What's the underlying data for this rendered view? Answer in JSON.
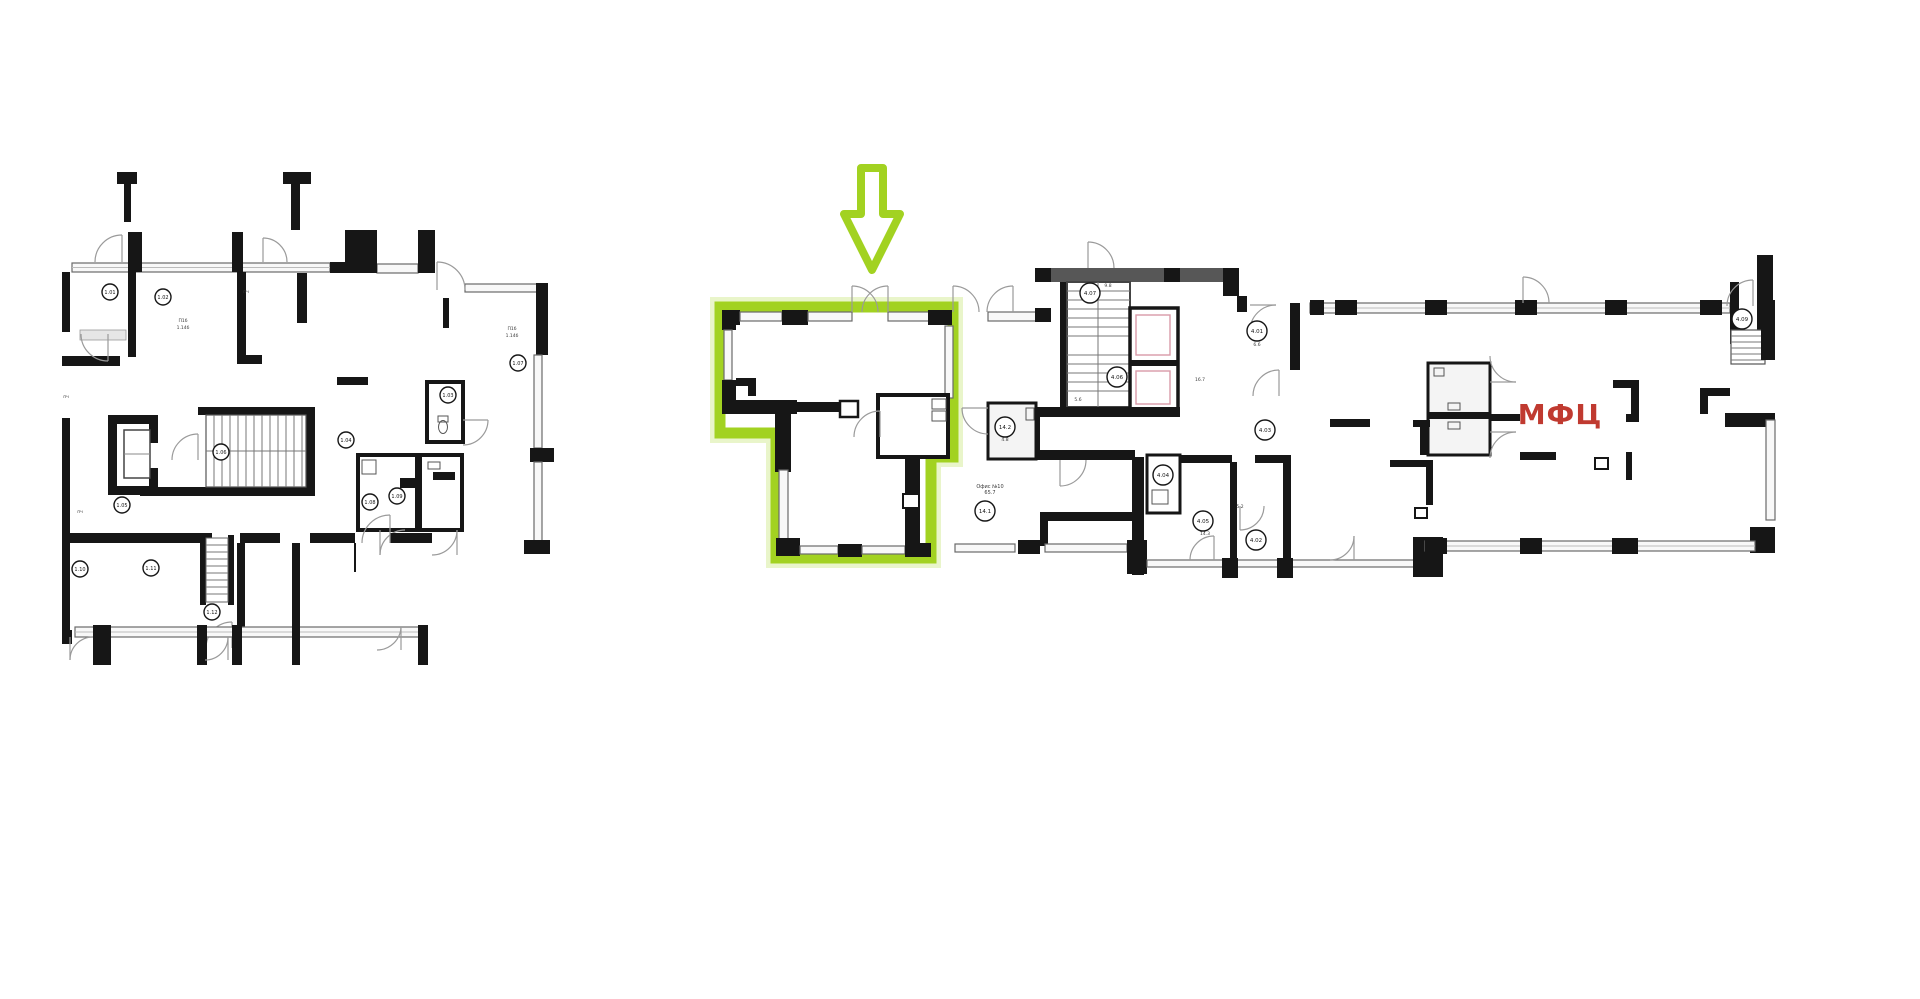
{
  "page": {
    "title": "floor-plan-view",
    "background": "#ffffff"
  },
  "colors": {
    "wall_black": "#161616",
    "wall_gray": "#575757",
    "window_edge": "#6a6a6a",
    "window_fill": "#f8f8f8",
    "door_arc": "#9a9a9a",
    "room_fill": "#f4f4f4",
    "elevator_pink": "#d99aa8",
    "highlight_green": "#a2d221",
    "highlight_glow": "#cfe98a",
    "label_red": "#c03a30",
    "note_gray": "#3a3a3a"
  },
  "annotations": {
    "mfc_label": "МФЦ",
    "arrow": "green-down-arrow pointing at highlighted unit"
  },
  "right_plan": {
    "office_note_line1": "Офис №10",
    "office_note_line2": "65.7",
    "room_markers": [
      {
        "label": "4.07",
        "x": 1090,
        "y": 293
      },
      {
        "label": "4.06",
        "x": 1117,
        "y": 377
      },
      {
        "label": "4.01",
        "x": 1257,
        "y": 331
      },
      {
        "label": "4.03",
        "x": 1265,
        "y": 430
      },
      {
        "label": "14.2",
        "x": 1005,
        "y": 427
      },
      {
        "label": "4.04",
        "x": 1163,
        "y": 475
      },
      {
        "label": "4.05",
        "x": 1203,
        "y": 521
      },
      {
        "label": "4.02",
        "x": 1256,
        "y": 540
      },
      {
        "label": "14.1",
        "x": 985,
        "y": 511
      },
      {
        "label": "4.09",
        "x": 1742,
        "y": 319
      }
    ],
    "notes": [
      {
        "text": "9.8",
        "x": 1108,
        "y": 287
      },
      {
        "text": "5.6",
        "x": 1078,
        "y": 401
      },
      {
        "text": "16.7",
        "x": 1200,
        "y": 381
      },
      {
        "text": "6.6",
        "x": 1257,
        "y": 346
      },
      {
        "text": "4.8",
        "x": 1005,
        "y": 441
      },
      {
        "text": "14.3",
        "x": 1205,
        "y": 535
      },
      {
        "text": "5.2",
        "x": 1240,
        "y": 508
      }
    ]
  },
  "left_plan": {
    "room_markers": [
      {
        "label": "1.01",
        "x": 110,
        "y": 292
      },
      {
        "label": "1.02",
        "x": 163,
        "y": 297
      },
      {
        "label": "1.03",
        "x": 448,
        "y": 395
      },
      {
        "label": "1.04",
        "x": 346,
        "y": 440
      },
      {
        "label": "1.05",
        "x": 122,
        "y": 505
      },
      {
        "label": "1.06",
        "x": 221,
        "y": 452
      },
      {
        "label": "1.07",
        "x": 518,
        "y": 363
      },
      {
        "label": "1.08",
        "x": 370,
        "y": 502
      },
      {
        "label": "1.09",
        "x": 397,
        "y": 496
      },
      {
        "label": "1.10",
        "x": 80,
        "y": 569
      },
      {
        "label": "1.11",
        "x": 151,
        "y": 568
      },
      {
        "label": "1.12",
        "x": 212,
        "y": 612
      }
    ],
    "notes": [
      {
        "text": "П1б",
        "x": 183,
        "y": 322
      },
      {
        "text": "1.14б",
        "x": 183,
        "y": 329
      },
      {
        "text": "П1б",
        "x": 512,
        "y": 330
      },
      {
        "text": "1.14б",
        "x": 512,
        "y": 337
      },
      {
        "text": "пч",
        "x": 80,
        "y": 513
      },
      {
        "text": "пч",
        "x": 66,
        "y": 398
      },
      {
        "text": "пч",
        "x": 246,
        "y": 293
      }
    ]
  }
}
